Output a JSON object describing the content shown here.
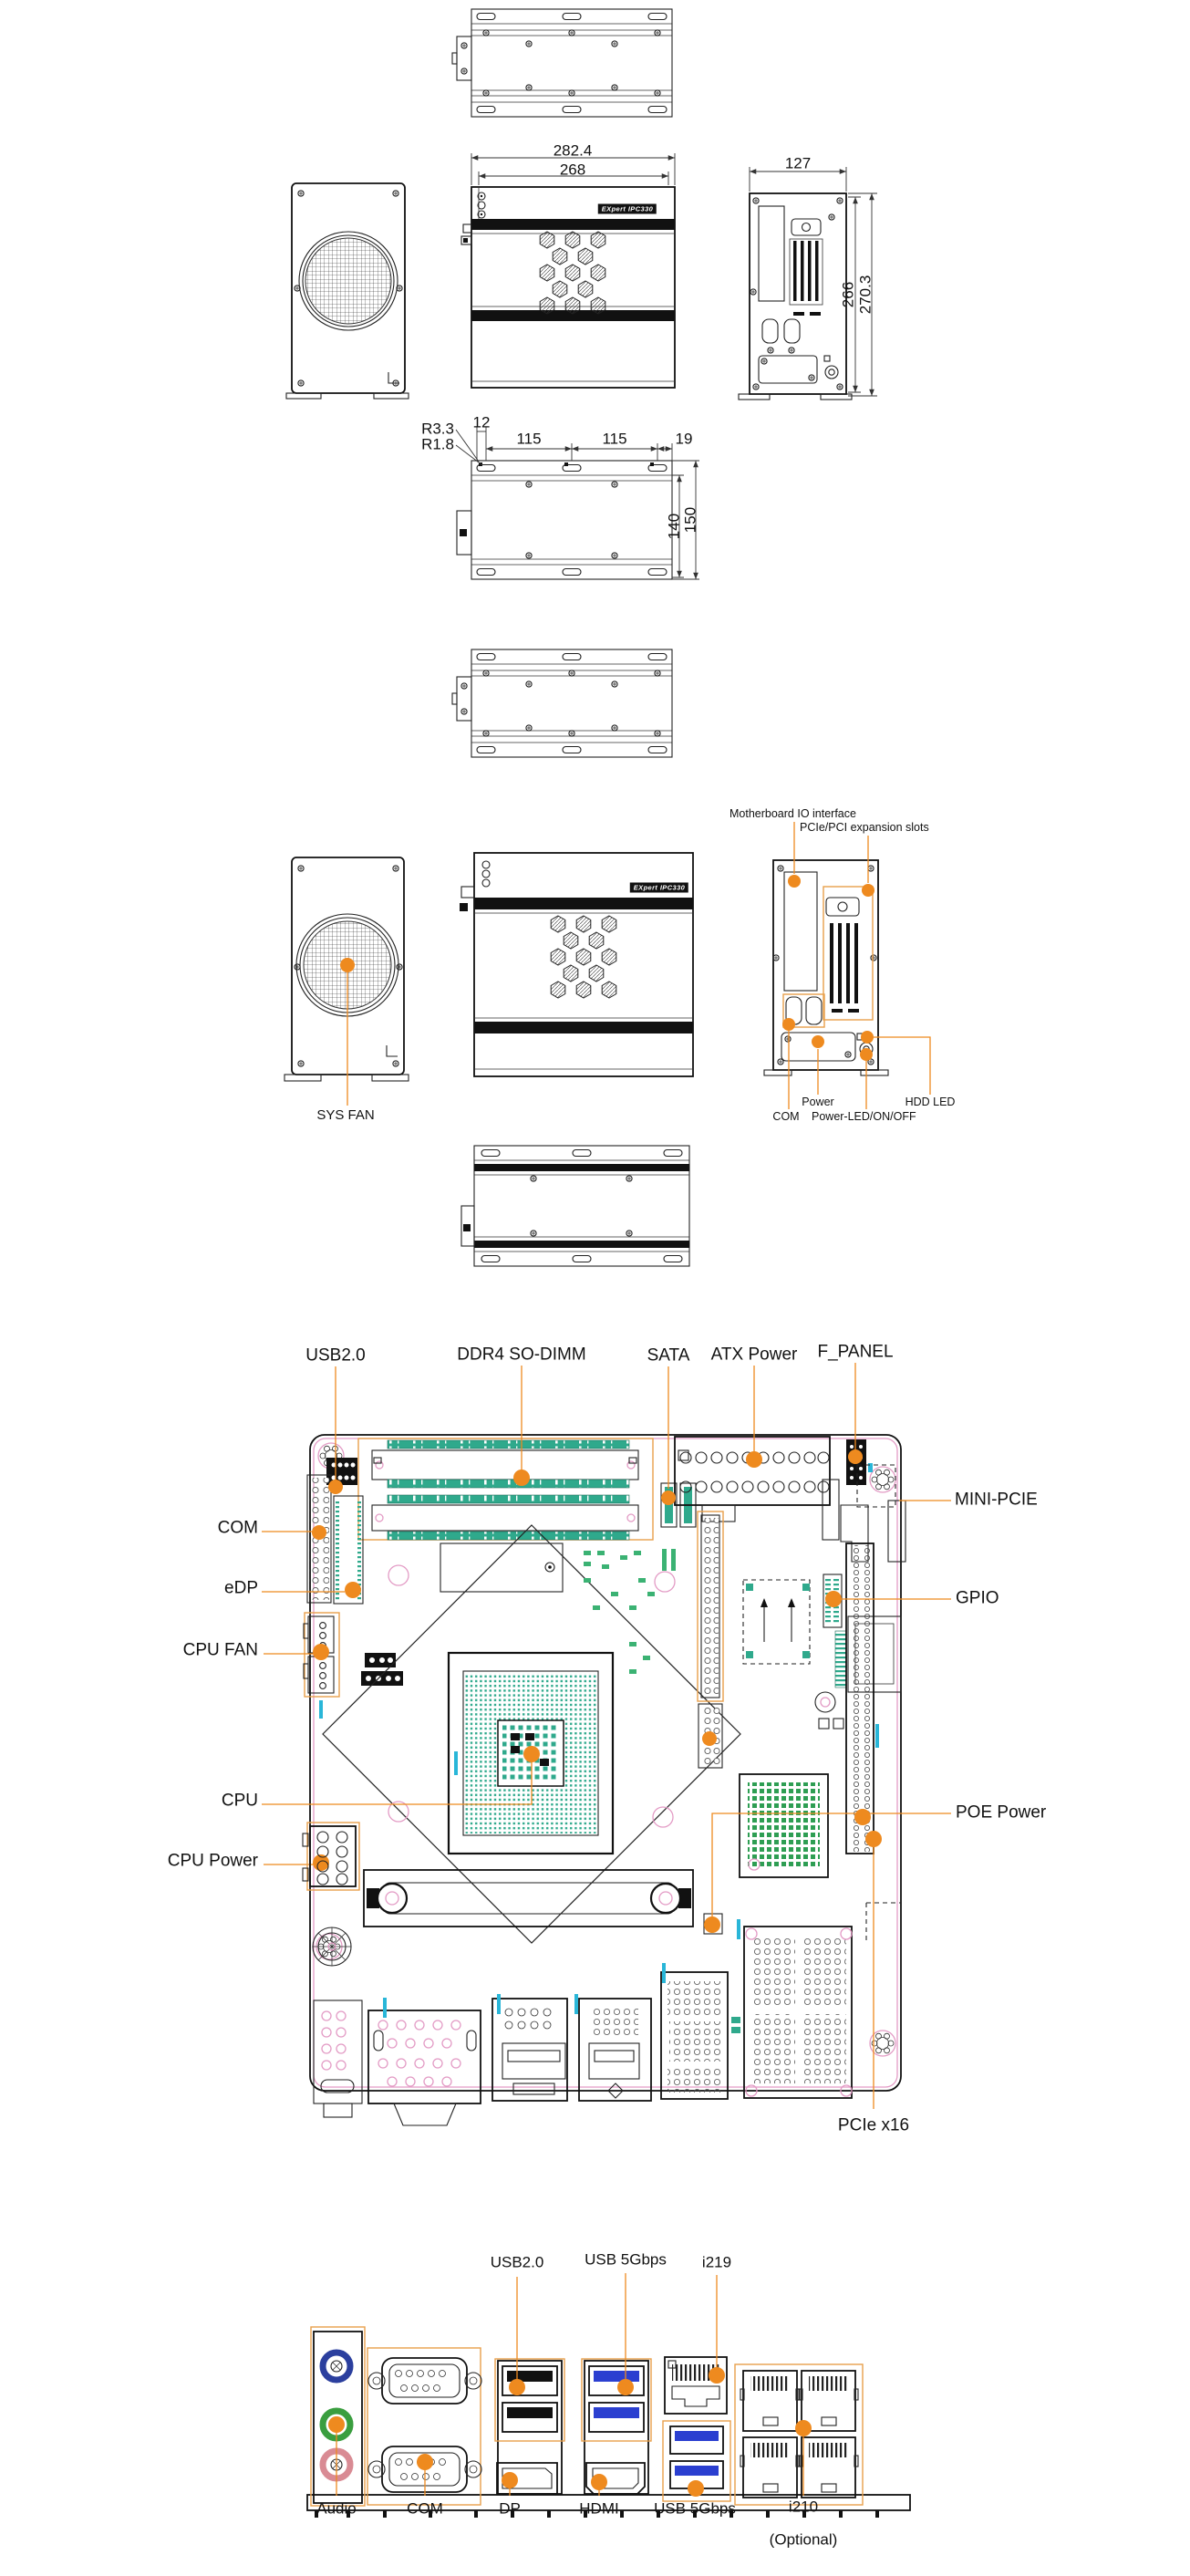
{
  "colors": {
    "accent_orange": "#EE8A1F",
    "outline_orange": "#E8A04B",
    "connector_teal": "#2FA98C",
    "silkscreen_cyan": "#29B6D8",
    "pcb_pink": "#E39BC5",
    "usb3_blue": "#2B3FD0",
    "audio_blue": "#2B3F9E",
    "audio_green": "#3A9E3F",
    "audio_pink": "#D98B94"
  },
  "chassis": {
    "badge": "EXpert IPC330",
    "dims": {
      "front_outer": "282.4",
      "front_inner": "268",
      "side_width": "127",
      "side_inner": "266",
      "side_outer": "270.3",
      "r_outer": "R3.3",
      "r_inner": "R1.8",
      "pitch_a": "12",
      "pitch_b": "115",
      "pitch_c": "115",
      "pitch_d": "19",
      "height_inner": "140",
      "height_outer": "150"
    },
    "callouts": {
      "sys_fan": "SYS FAN",
      "mb_io": "Motherboard IO interface",
      "slots": "PCIe/PCI expansion slots",
      "power": "Power",
      "com": "COM",
      "power_led": "Power-LED/ON/OFF",
      "hdd_led": "HDD LED"
    }
  },
  "motherboard": {
    "callouts": {
      "usb20": "USB2.0",
      "dimm": "DDR4 SO-DIMM",
      "sata": "SATA",
      "atx": "ATX Power",
      "f_panel": "F_PANEL",
      "mini_pcie": "MINI-PCIE",
      "gpio": "GPIO",
      "poe": "POE Power",
      "pcie_x16": "PCIe x16",
      "com": "COM",
      "edp": "eDP",
      "cpu_fan": "CPU FAN",
      "cpu": "CPU",
      "cpu_power": "CPU Power"
    }
  },
  "io_panel": {
    "callouts": {
      "usb20": "USB2.0",
      "usb5_top": "USB 5Gbps",
      "i219": "i219",
      "audio": "Audio",
      "com": "COM",
      "dp": "DP",
      "hdmi": "HDMI",
      "usb5_bottom": "USB 5Gbps",
      "i210": "i210",
      "i210_note": "(Optional)"
    }
  }
}
